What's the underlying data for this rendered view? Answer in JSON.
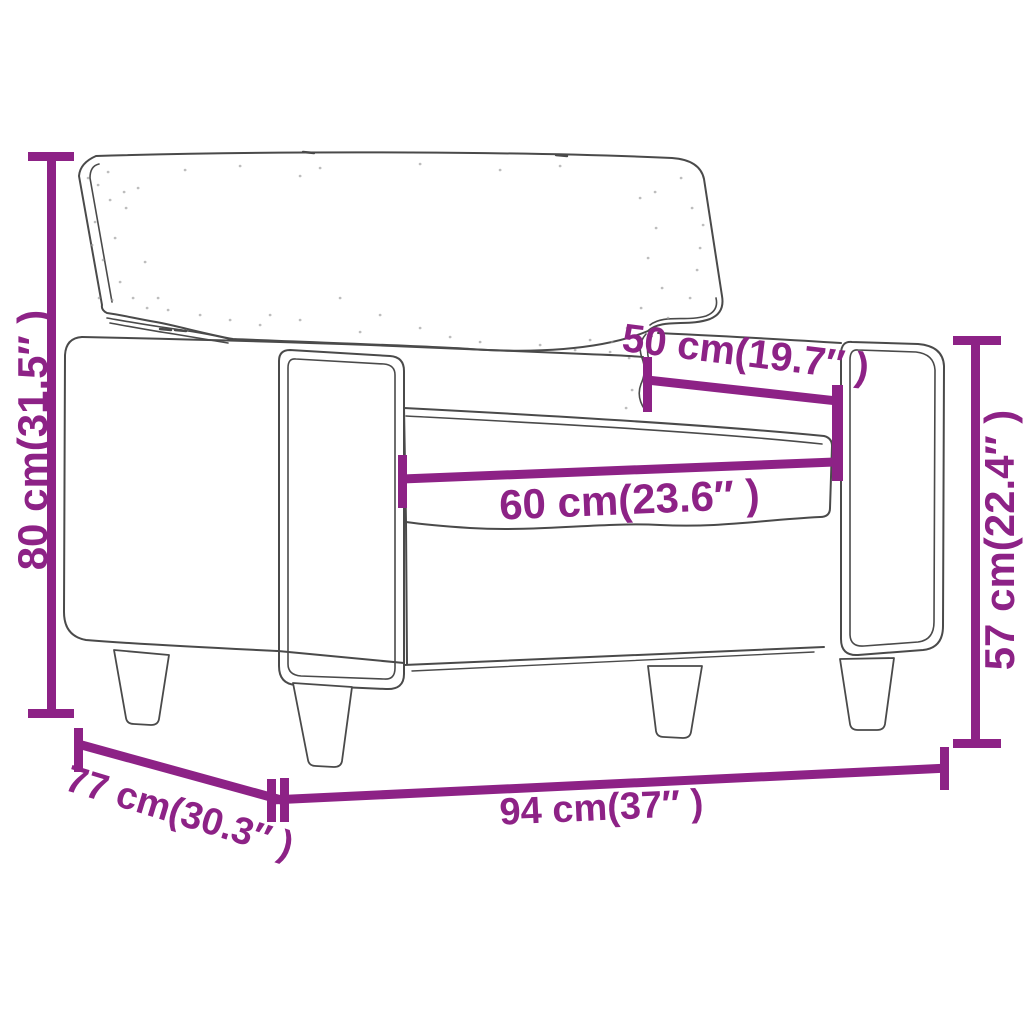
{
  "figure": {
    "colors": {
      "dimension": "#8D2286",
      "line_art": "#4A4A4A",
      "background": "#ffffff"
    }
  },
  "dimensions": {
    "height": {
      "label": "80 cm(31.5″ )",
      "cm": 80,
      "inches": 31.5
    },
    "depth": {
      "label": "77 cm(30.3″ )",
      "cm": 77,
      "inches": 30.3
    },
    "width": {
      "label": "94 cm(37″ )",
      "cm": 94,
      "inches": 37
    },
    "seat_depth": {
      "label": "50 cm(19.7″ )",
      "cm": 50,
      "inches": 19.7
    },
    "seat_width": {
      "label": "60 cm(23.6″ )",
      "cm": 60,
      "inches": 23.6
    },
    "arm_height": {
      "label": "57 cm(22.4″ )",
      "cm": 57,
      "inches": 22.4
    }
  }
}
